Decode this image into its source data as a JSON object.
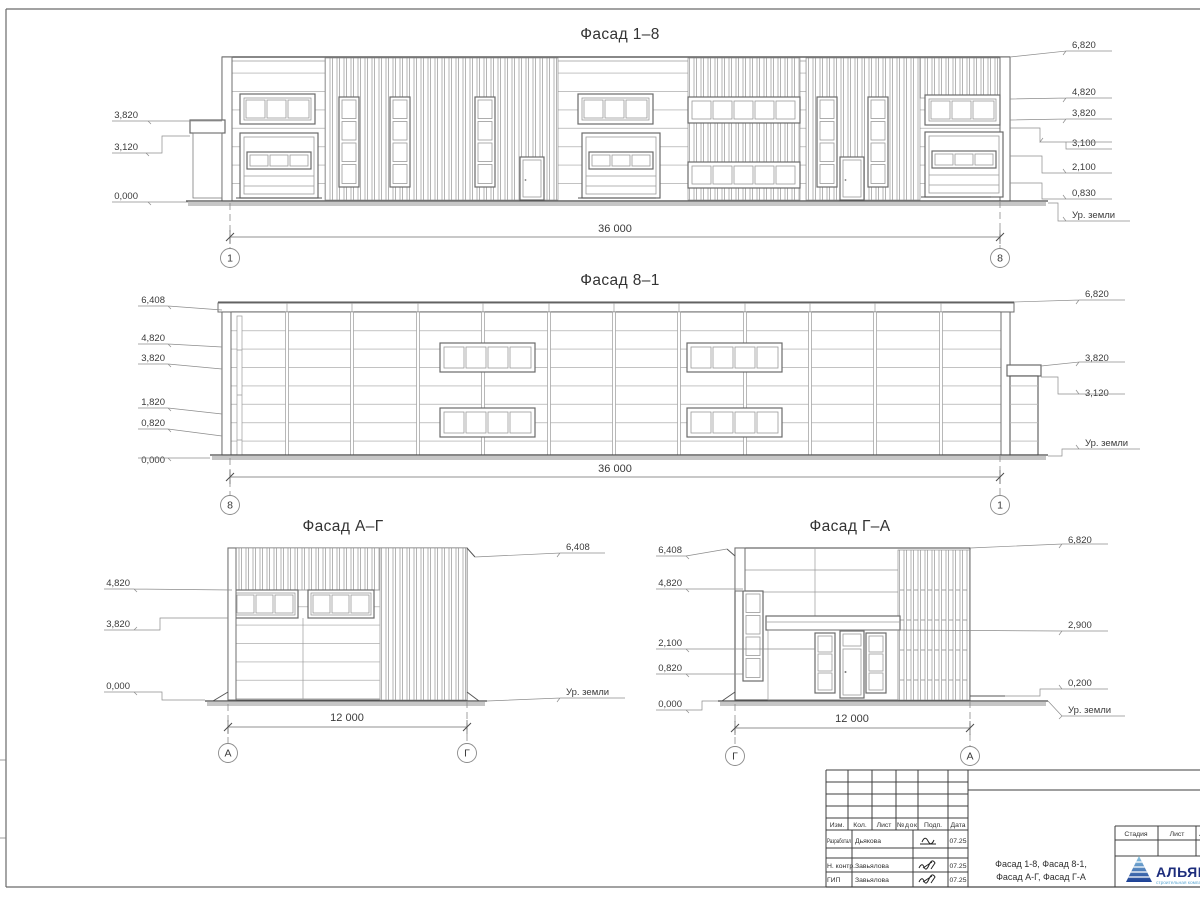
{
  "colors": {
    "line": "#565656",
    "logo_navy": "#1d2d7c",
    "logo_light": "#5fa8d3"
  },
  "f18": {
    "title": "Фасад 1–8",
    "left": [
      "3,820",
      "3,120",
      "0,000"
    ],
    "right": [
      "6,820",
      "4,820",
      "3,820",
      "3,100",
      "2,100",
      "0,830"
    ],
    "ground": "Ур. земли",
    "dim": "36 000",
    "axL": "1",
    "axR": "8"
  },
  "f81": {
    "title": "Фасад 8–1",
    "left": [
      "6,408",
      "4,820",
      "3,820",
      "1,820",
      "0,820",
      "0,000"
    ],
    "right": [
      "6,820",
      "3,820",
      "3,120"
    ],
    "ground": "Ур. земли",
    "dim": "36 000",
    "axL": "8",
    "axR": "1"
  },
  "fag": {
    "title": "Фасад А–Г",
    "left": [
      "4,820",
      "3,820",
      "0,000"
    ],
    "right": [
      "6,408"
    ],
    "ground": "Ур. земли",
    "dim": "12 000",
    "axL": "А",
    "axR": "Г"
  },
  "fga": {
    "title": "Фасад Г–А",
    "left": [
      "6,408",
      "4,820",
      "2,100",
      "0,820",
      "0,000"
    ],
    "right": [
      "6,820",
      "2,900",
      "0,200"
    ],
    "ground": "Ур. земли",
    "dim": "12 000",
    "axL": "Г",
    "axR": "А"
  },
  "tb": {
    "cols": [
      "Изм.",
      "Кол.",
      "Лист",
      "№док",
      "Подп.",
      "Дата"
    ],
    "rows": [
      {
        "role": "Разработал",
        "name": "Дьякова",
        "date": "07.25"
      },
      {
        "role": "Н. контр.",
        "name": "Завьялова",
        "date": "07.25"
      },
      {
        "role": "ГИП",
        "name": "Завьялова",
        "date": "07.25"
      }
    ],
    "stage": [
      "Стадия",
      "Лист",
      "Листов"
    ],
    "doc1": "Фасад 1-8, Фасад 8-1,",
    "doc2": "Фасад А-Г, Фасад Г-А",
    "logo": "АЛЬЯНС",
    "logo_sub": "строительная компания"
  }
}
